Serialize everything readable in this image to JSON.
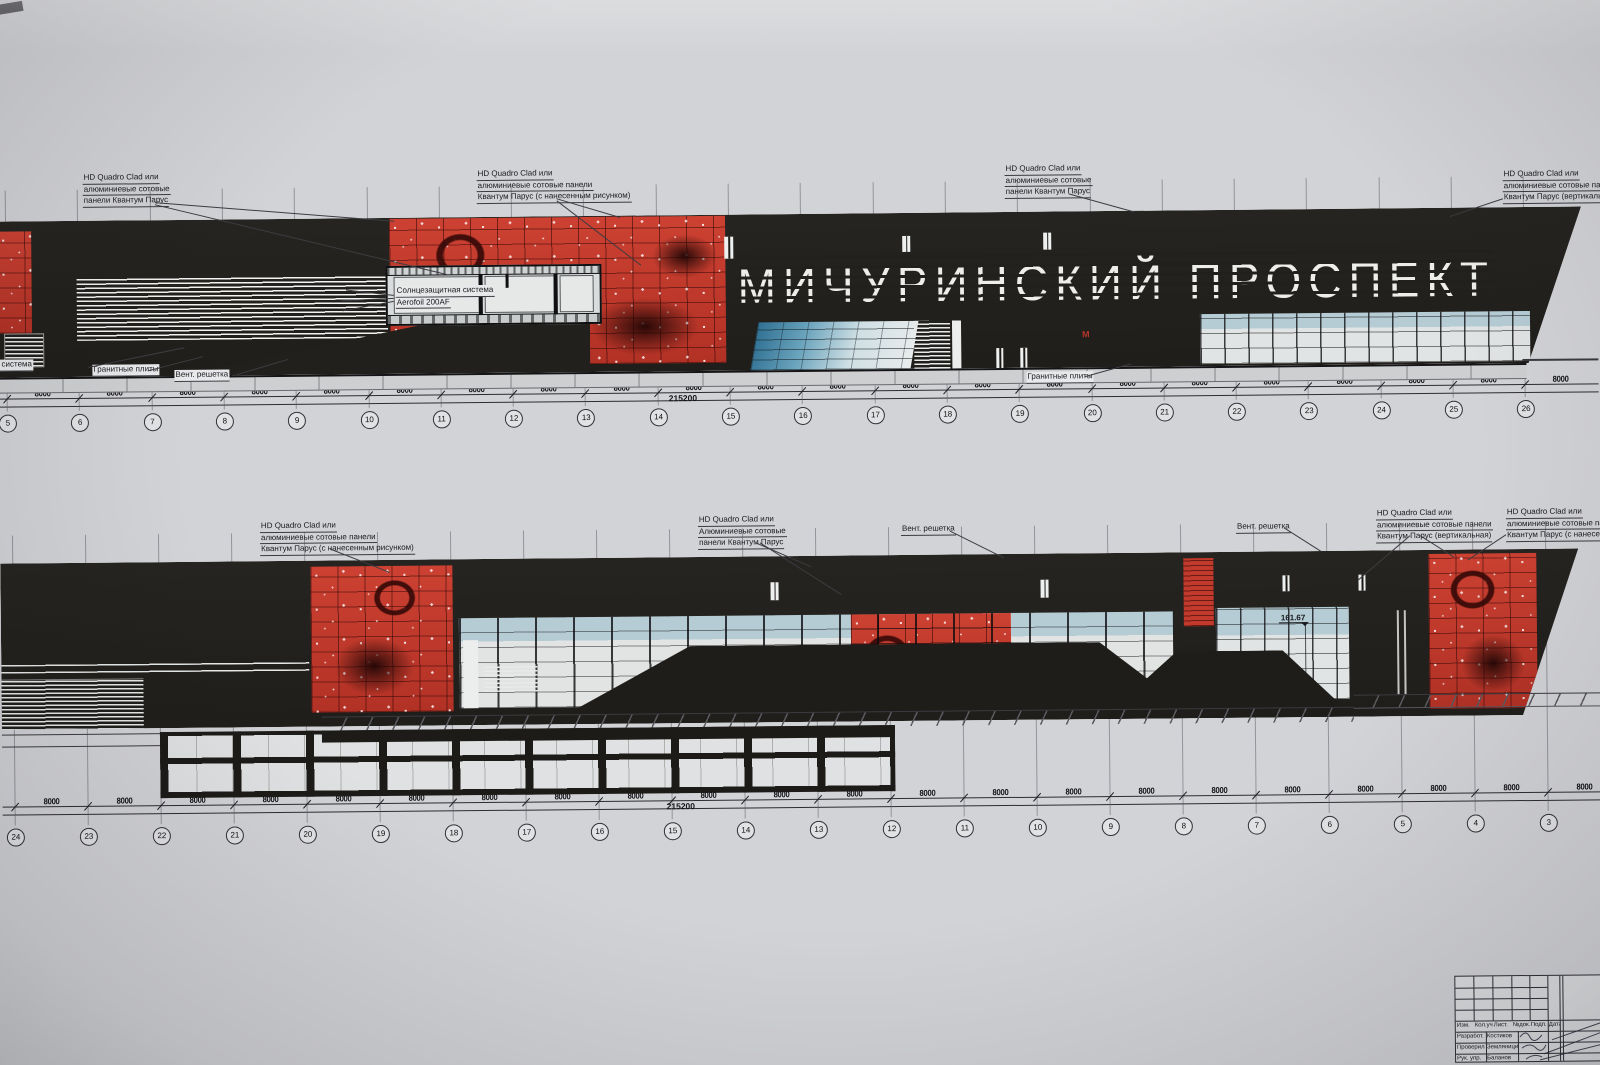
{
  "colors": {
    "paper": "#d2d3d6",
    "band": "#23211d",
    "red_panel": "#c23a2b",
    "glass_blue": "#5890ab",
    "panel_light": "#e2e5e6"
  },
  "sign": {
    "text": "МИЧУРИНСКИЙ ПРОСПЕКТ"
  },
  "metro_logo": "М",
  "level_mark": {
    "value": "161.67"
  },
  "dimensions": {
    "bay": "8000",
    "total": "215200"
  },
  "axes": {
    "top": [
      "5",
      "6",
      "7",
      "8",
      "9",
      "10",
      "11",
      "12",
      "13",
      "14",
      "15",
      "16",
      "17",
      "18",
      "19",
      "20",
      "21",
      "22",
      "23",
      "24",
      "25",
      "26"
    ],
    "bottom": [
      "24",
      "23",
      "22",
      "21",
      "20",
      "19",
      "18",
      "17",
      "16",
      "15",
      "14",
      "13",
      "12",
      "11",
      "10",
      "9",
      "8",
      "7",
      "6",
      "5",
      "4",
      "3"
    ]
  },
  "labels": {
    "hd3_panels": [
      "HD Quadro Clad или",
      "алюминиевые сотовые",
      "панели Квантум Парус"
    ],
    "hd3_panels2": [
      "HD Quadro Clad или",
      "Алюминиевые сотовые",
      "панели Квантум Парус"
    ],
    "hd3_pattern": [
      "HD Quadro Clad или",
      "алюминиевые сотовые панели",
      "Квантум Парус (с нанесенным рисунком)"
    ],
    "hd3_vertical": [
      "HD Quadro Clad или",
      "алюминиевые сотовые панели",
      "Квантум Парус (вертикальная)"
    ],
    "sun_system": [
      "Солнцезащитная система",
      "Aerofoil 200AF"
    ],
    "granite": "Гранитные плиты",
    "vent": "Вент. решетка"
  },
  "titleblock": {
    "header": [
      "Изм.",
      "Кол.уч.",
      "Лист.",
      "№док.",
      "Подп.",
      "Дата"
    ],
    "rows": [
      {
        "role": "Разработ.",
        "name": "Костиков"
      },
      {
        "role": "Проверил",
        "name": "Земляницин"
      },
      {
        "role": "Рук. упр.",
        "name": "Баланов"
      }
    ]
  }
}
